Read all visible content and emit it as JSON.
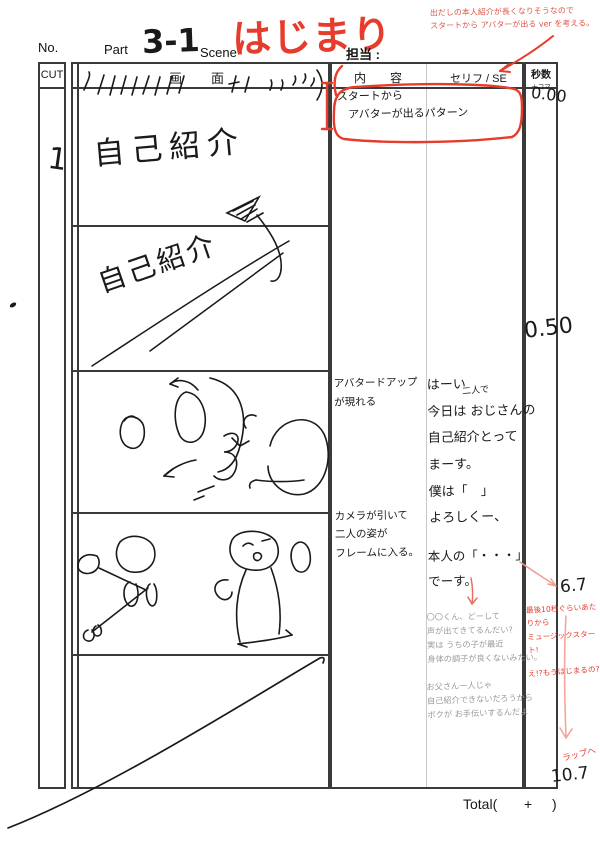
{
  "header": {
    "no_label": "No.",
    "part_label": "Part",
    "part_value": "3-1",
    "scene_label": "Scene",
    "scene_value": "はじまり",
    "assignee_label": "担当 :",
    "margin_note": "出だしの本人紹介が長くなりそうなので\nスタートから アバターが出る ver を考える。"
  },
  "columns": {
    "cut": "CUT",
    "screen": "画　面",
    "content": "内　容",
    "dialogue": "セリフ / SE",
    "seconds": "秒数",
    "seconds_sub": "＋コマ"
  },
  "cut": {
    "number": "1"
  },
  "screen_panels": {
    "panel1_text": "自己紹介",
    "panel2_text": "自己紹介"
  },
  "content_notes": {
    "boxed": "スタートから\n　アバターが出るパターン",
    "avatar_up": "アバタードアップ\nが現れる",
    "camera": "カメラが引いて\n二人の姿が\nフレームに入る。"
  },
  "dialogue": {
    "insert": "二人で",
    "main": "はーい\n今日は おじさんの\n自己紹介とって\nまーす。\n僕は「　」\nよろしくー、",
    "main2": "本人の「・・・」\nでーす。",
    "pencil1": "〇〇くん、どーして\n声が出てきてるんだい?\n実は うちの子が最近\n身体の調子が良くないみたい。",
    "pencil2": "お父さん一人じゃ\n自己紹介できないだろうから\nボクが お手伝いするんだよ"
  },
  "timings": {
    "t1": "0.00",
    "t2": "0.50",
    "t3": "6.7",
    "t4": "10.7"
  },
  "margin_notes_red": {
    "music": "最後10秒ぐらいあたりから\nミュージックスタート!",
    "already": "え!?もうはじまるの?",
    "wrap": "ラップへ"
  },
  "footer": {
    "total_label": "Total(",
    "plus": "+",
    "close": ")"
  },
  "colors": {
    "red": "#e63c2c",
    "pink": "#f29b91",
    "pencil": "#9a9a9a"
  }
}
